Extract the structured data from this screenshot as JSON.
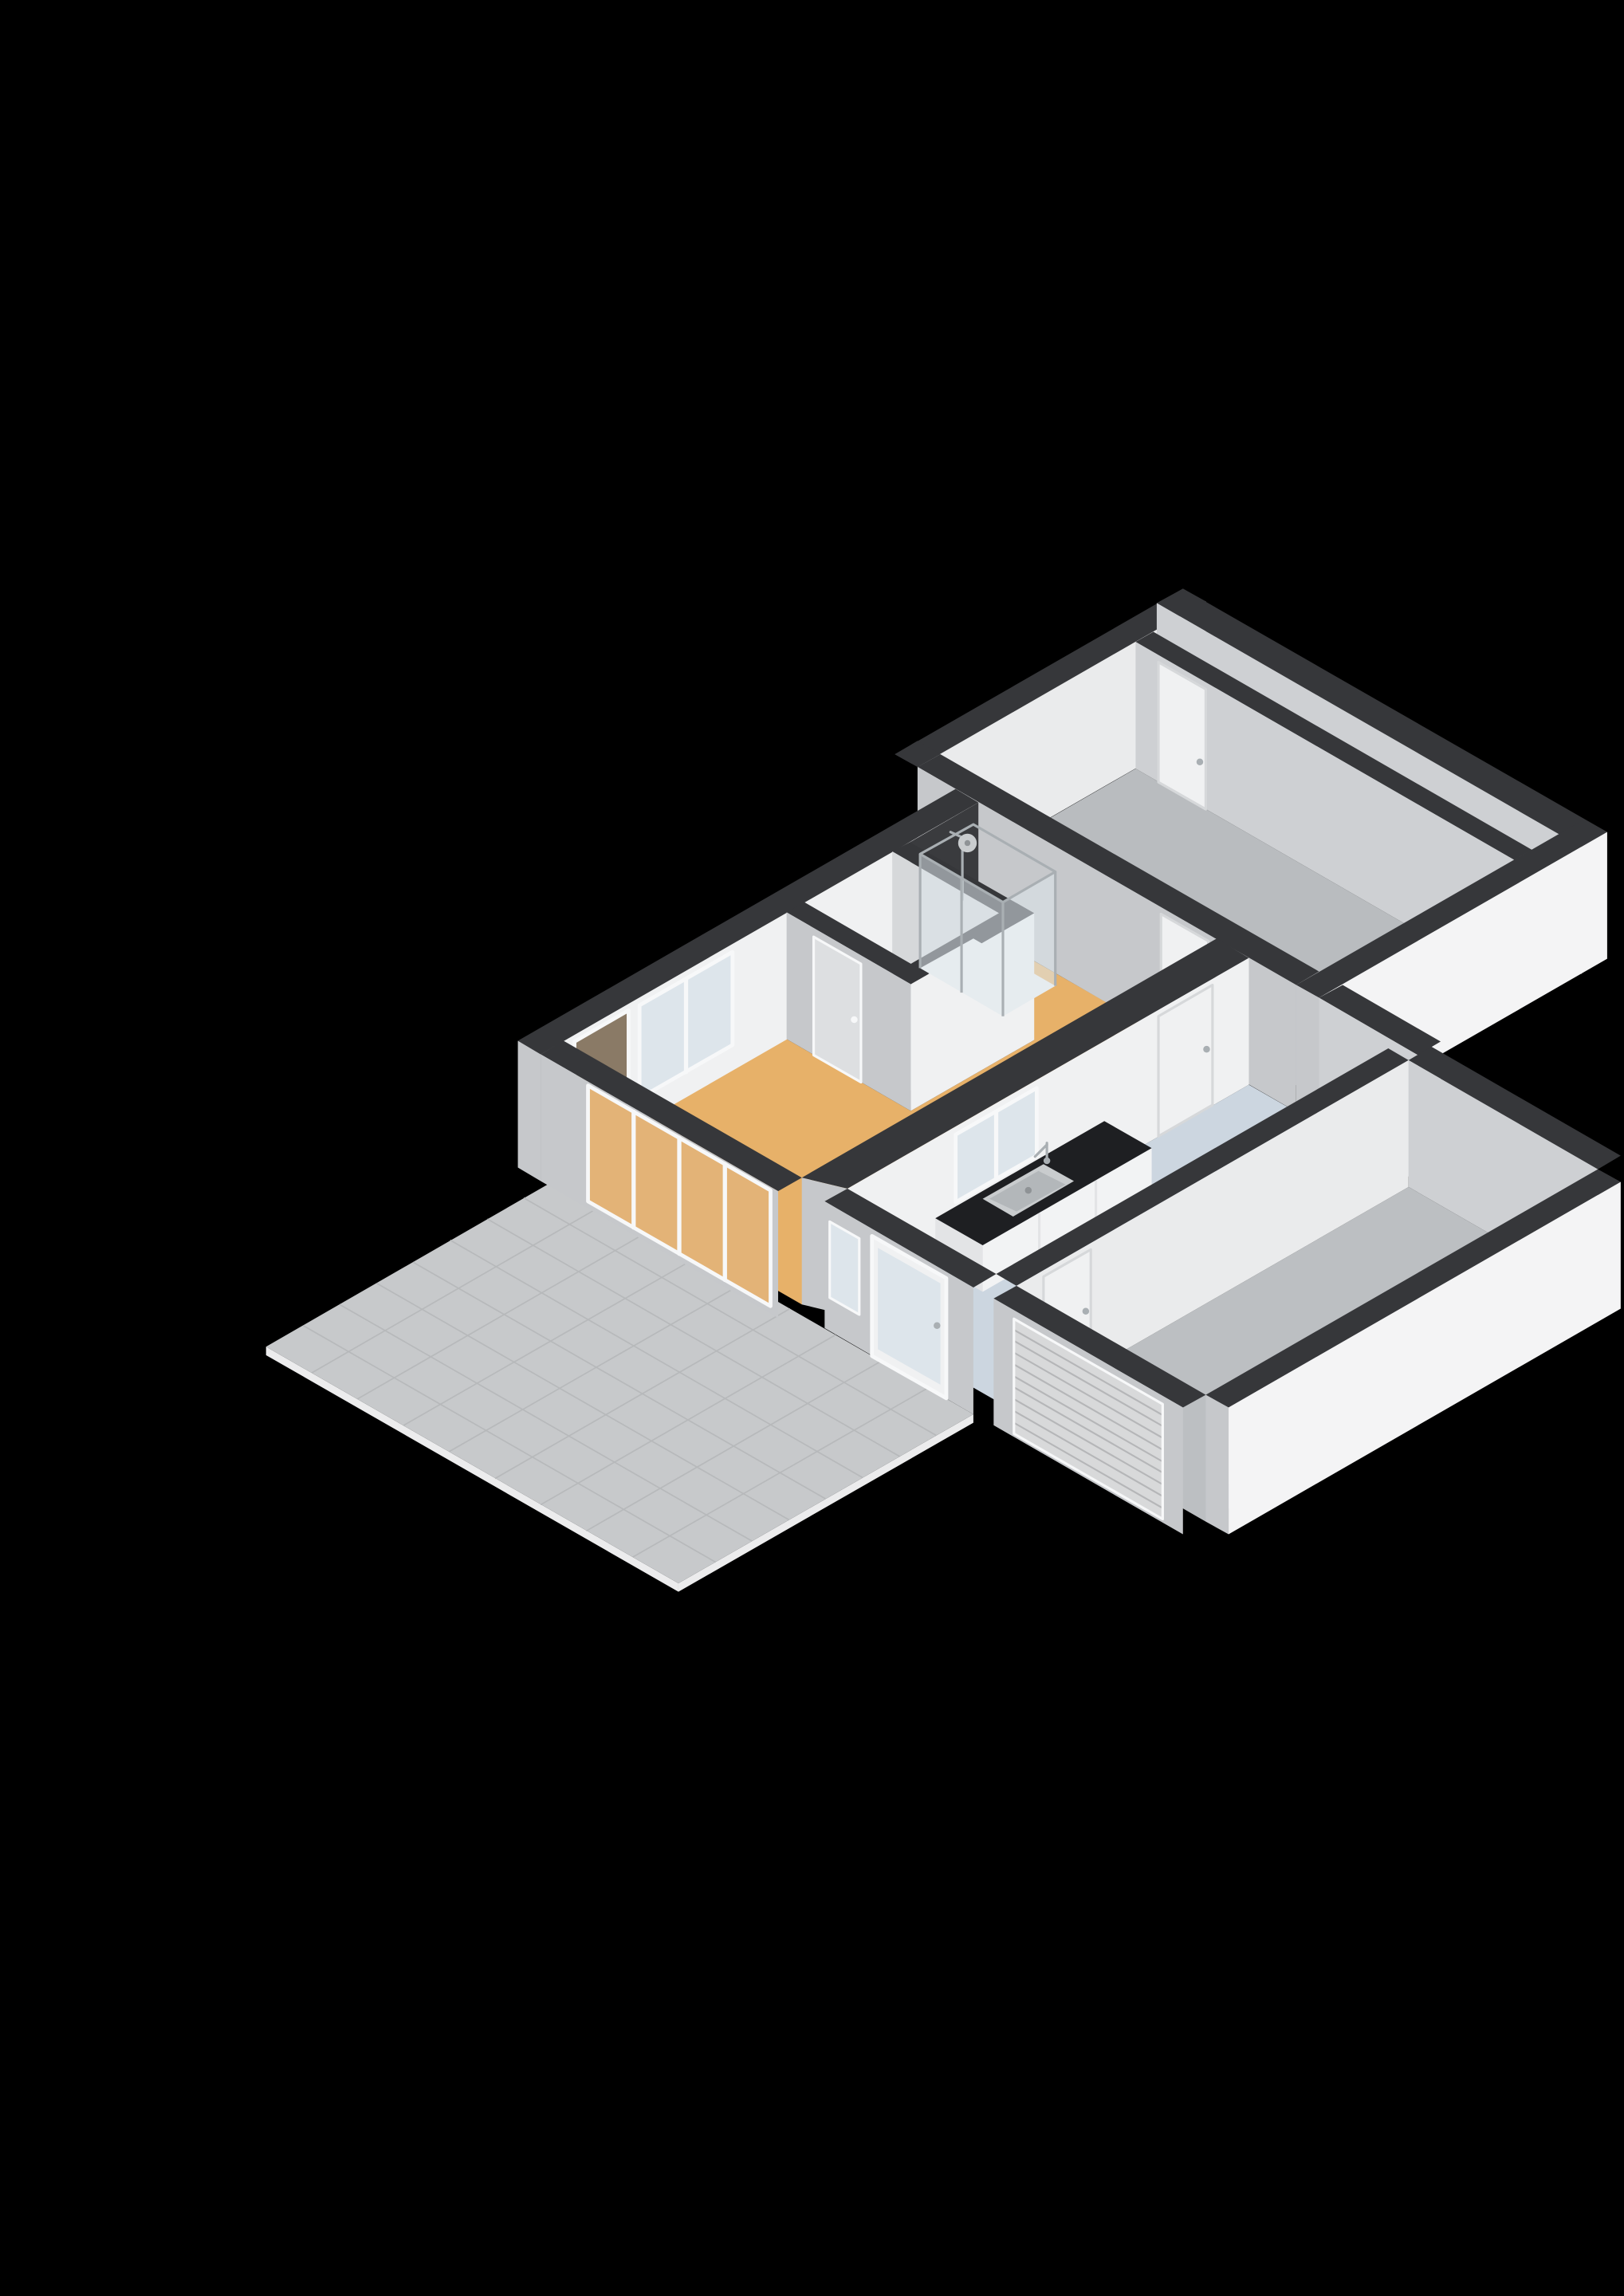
{
  "scene": {
    "type": "3d-floorplan-render",
    "background": "#000000",
    "colors": {
      "wall_top": "#36373a",
      "wall_top_light": "#3e3f42",
      "ext_white": "#f4f4f5",
      "ext_gray": "#c6c8cb",
      "int_light": "#eaebec",
      "int_lighter": "#f0f1f2",
      "int_gray": "#ced0d3",
      "int_gray2": "#d6d8da",
      "dark_niche": "#3a3b3e",
      "floor_living": "#e7b169",
      "floor_seen_through_glass": "#e3b377",
      "floor_corridor": "#bd976b",
      "floor_room_gray": "#b9bcbf",
      "floor_garage": "#bcbfc2",
      "floor_kitchen": "#ccd6e0",
      "floor_toilet": "#d8dfe7",
      "terrace_tile": "#c7c9cb",
      "terrace_line": "#b7b9bb",
      "terrace_edge": "#ececed",
      "counter_top": "#1e1f22",
      "cabinet_white": "#f2f3f4",
      "cabinet_side": "#e3e4e6",
      "glass": "#dde5eb",
      "glass_shower": "rgba(223,231,236,0.55)",
      "door_brown": "#8a7a66",
      "door_white": "#f0f1f2",
      "door_leaf_gray": "#dddfe1",
      "frame_white": "#f7f8f9",
      "chrome": "#a9afb3",
      "sink_steel": "#c9ccce",
      "sink_basin": "#b3b7ba",
      "drain": "#8f9396",
      "garage_door": "#d8d9da",
      "garage_door_line": "#b5b6b8"
    },
    "features": {
      "rooms": [
        "terrace",
        "living-area",
        "hallway",
        "toilet",
        "shower-area",
        "bedroom-large",
        "corridor-strip",
        "kitchen",
        "entrance",
        "garage"
      ],
      "furniture": [
        "shower-cabin",
        "kitchen-counter",
        "kitchen-sink",
        "faucet"
      ],
      "openings": [
        "sliding-glass-doors",
        "balcony-door",
        "living-window",
        "toilet-door",
        "bedroom-door",
        "hall-door",
        "kitchen-window",
        "kitchen-door",
        "entrance-window",
        "front-door",
        "garage-inner-door",
        "garage-roller-door"
      ]
    }
  }
}
